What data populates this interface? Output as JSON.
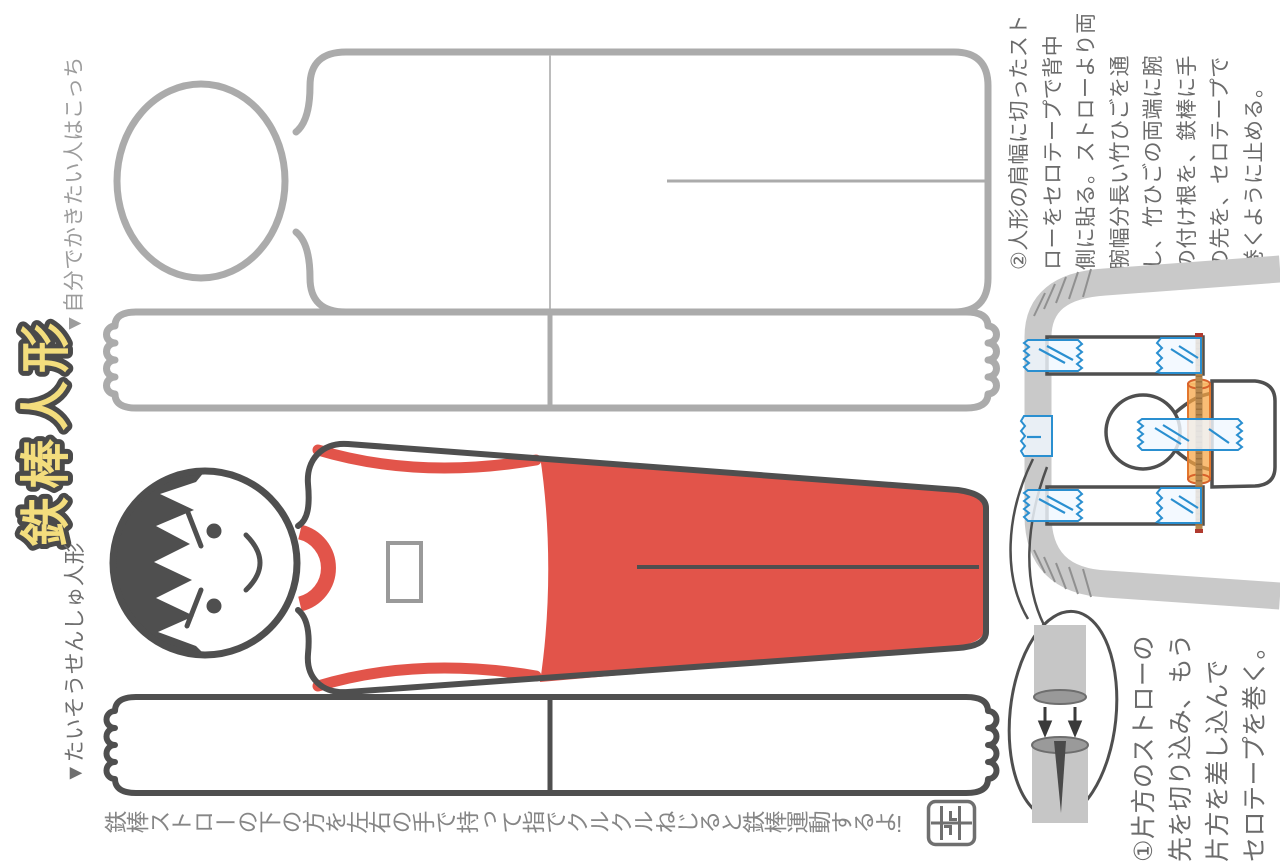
{
  "page": {
    "title": "鉄棒人形",
    "caption": "鉄棒ストローの下の方を左右の手で持って指でクルクルねじると鉄棒運動するよ!"
  },
  "labels": {
    "template": "▼自分でかきたい人はこっち",
    "gymnast": "▼たいそうせんしゅ人形"
  },
  "instructions": {
    "step1": "①片方のストローの\n先を切り込み、もう\n片方を差し込んで\nセロテープを巻く。",
    "step2": "②人形の肩幅に切ったスト\nローをセロテープで背中\n側に貼る。ストローより両\n腕幅分長い竹ひごを通\nし、竹ひごの両端に腕\nの付け根を、鉄棒に手\nの先を、セロテープで\n巻くように止める。"
  },
  "figures": {
    "template_figure": "blank doll template (head, body, two-arm strip with finger ends)",
    "gymnast_figure": "gymnast doll with dark hair, white tank top, red leotard",
    "diagram": "straw horizontal bar with bamboo skewer through back straw, taped arms",
    "balloon": "cut one straw end and insert the other straw"
  },
  "icons": {
    "seal": "artist-seal",
    "marker": "▼"
  },
  "colors": {
    "accent-red": "#e2544a",
    "title-yellow": "#f3dd7d",
    "title-outline": "#4a4a4a",
    "outline-dark": "#4f4f4f",
    "template-gray": "#ababab",
    "tape-blue": "#2a8fd0",
    "skewer-brown": "#b6874e",
    "straw-orange": "#f6a441",
    "straw-gray": "#c9c9c9"
  }
}
